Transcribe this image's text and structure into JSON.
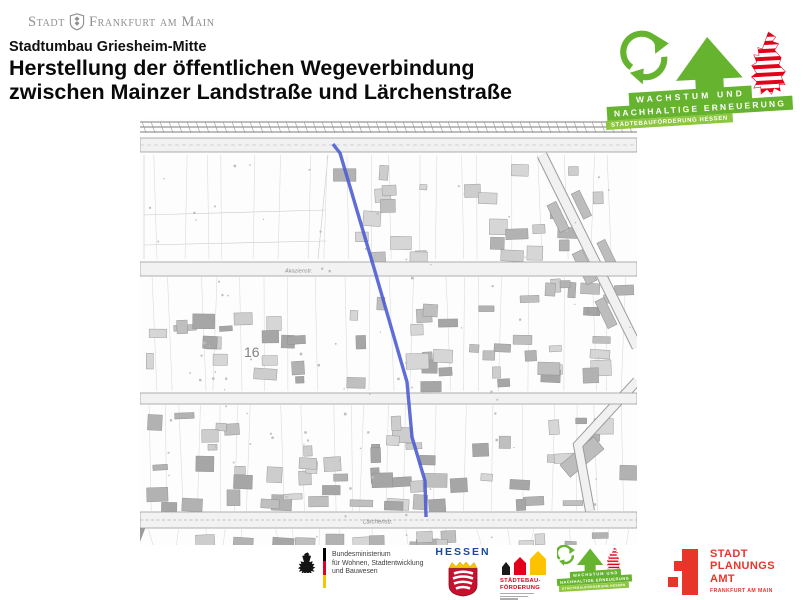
{
  "header": {
    "city_logo": {
      "word1": "Stadt",
      "word2": "Frankfurt am Main"
    },
    "project": "Stadtumbau Griesheim-Mitte",
    "title_line1": "Herstellung der öffentlichen Wegeverbindung",
    "title_line2": "zwischen Mainzer Landstraße und Lärchenstraße"
  },
  "program_logo": {
    "band1": "WACHSTUM UND",
    "band2": "NACHHALTIGE ERNEUERUNG",
    "band3": "STÄDTEBAUFÖRDERUNG HESSEN",
    "green": "#65b32e",
    "band3_green": "#8dc63f",
    "lion_red": "#e2001a"
  },
  "map": {
    "parcel_number": "16",
    "street_top_label": "Akazienstr.",
    "street_bottom_label": "Lärchenstr.",
    "path_color": "#4d5ed1"
  },
  "footer": {
    "bmwsb": {
      "line1": "Bundesministerium",
      "line2": "für Wohnen, Stadtentwicklung",
      "line3": "und Bauwesen"
    },
    "hessen_label": "HESSEN",
    "hessen_blue": "#164a9a",
    "sbf_line1": "STÄDTEBAU-",
    "sbf_line2": "FÖRDERUNG",
    "sbf_red": "#e2001a",
    "spa": {
      "line1": "STADT",
      "line2": "PLANUNGS",
      "line3": "AMT",
      "sub": "FRANKFURT AM MAIN",
      "red": "#e8352a"
    }
  }
}
